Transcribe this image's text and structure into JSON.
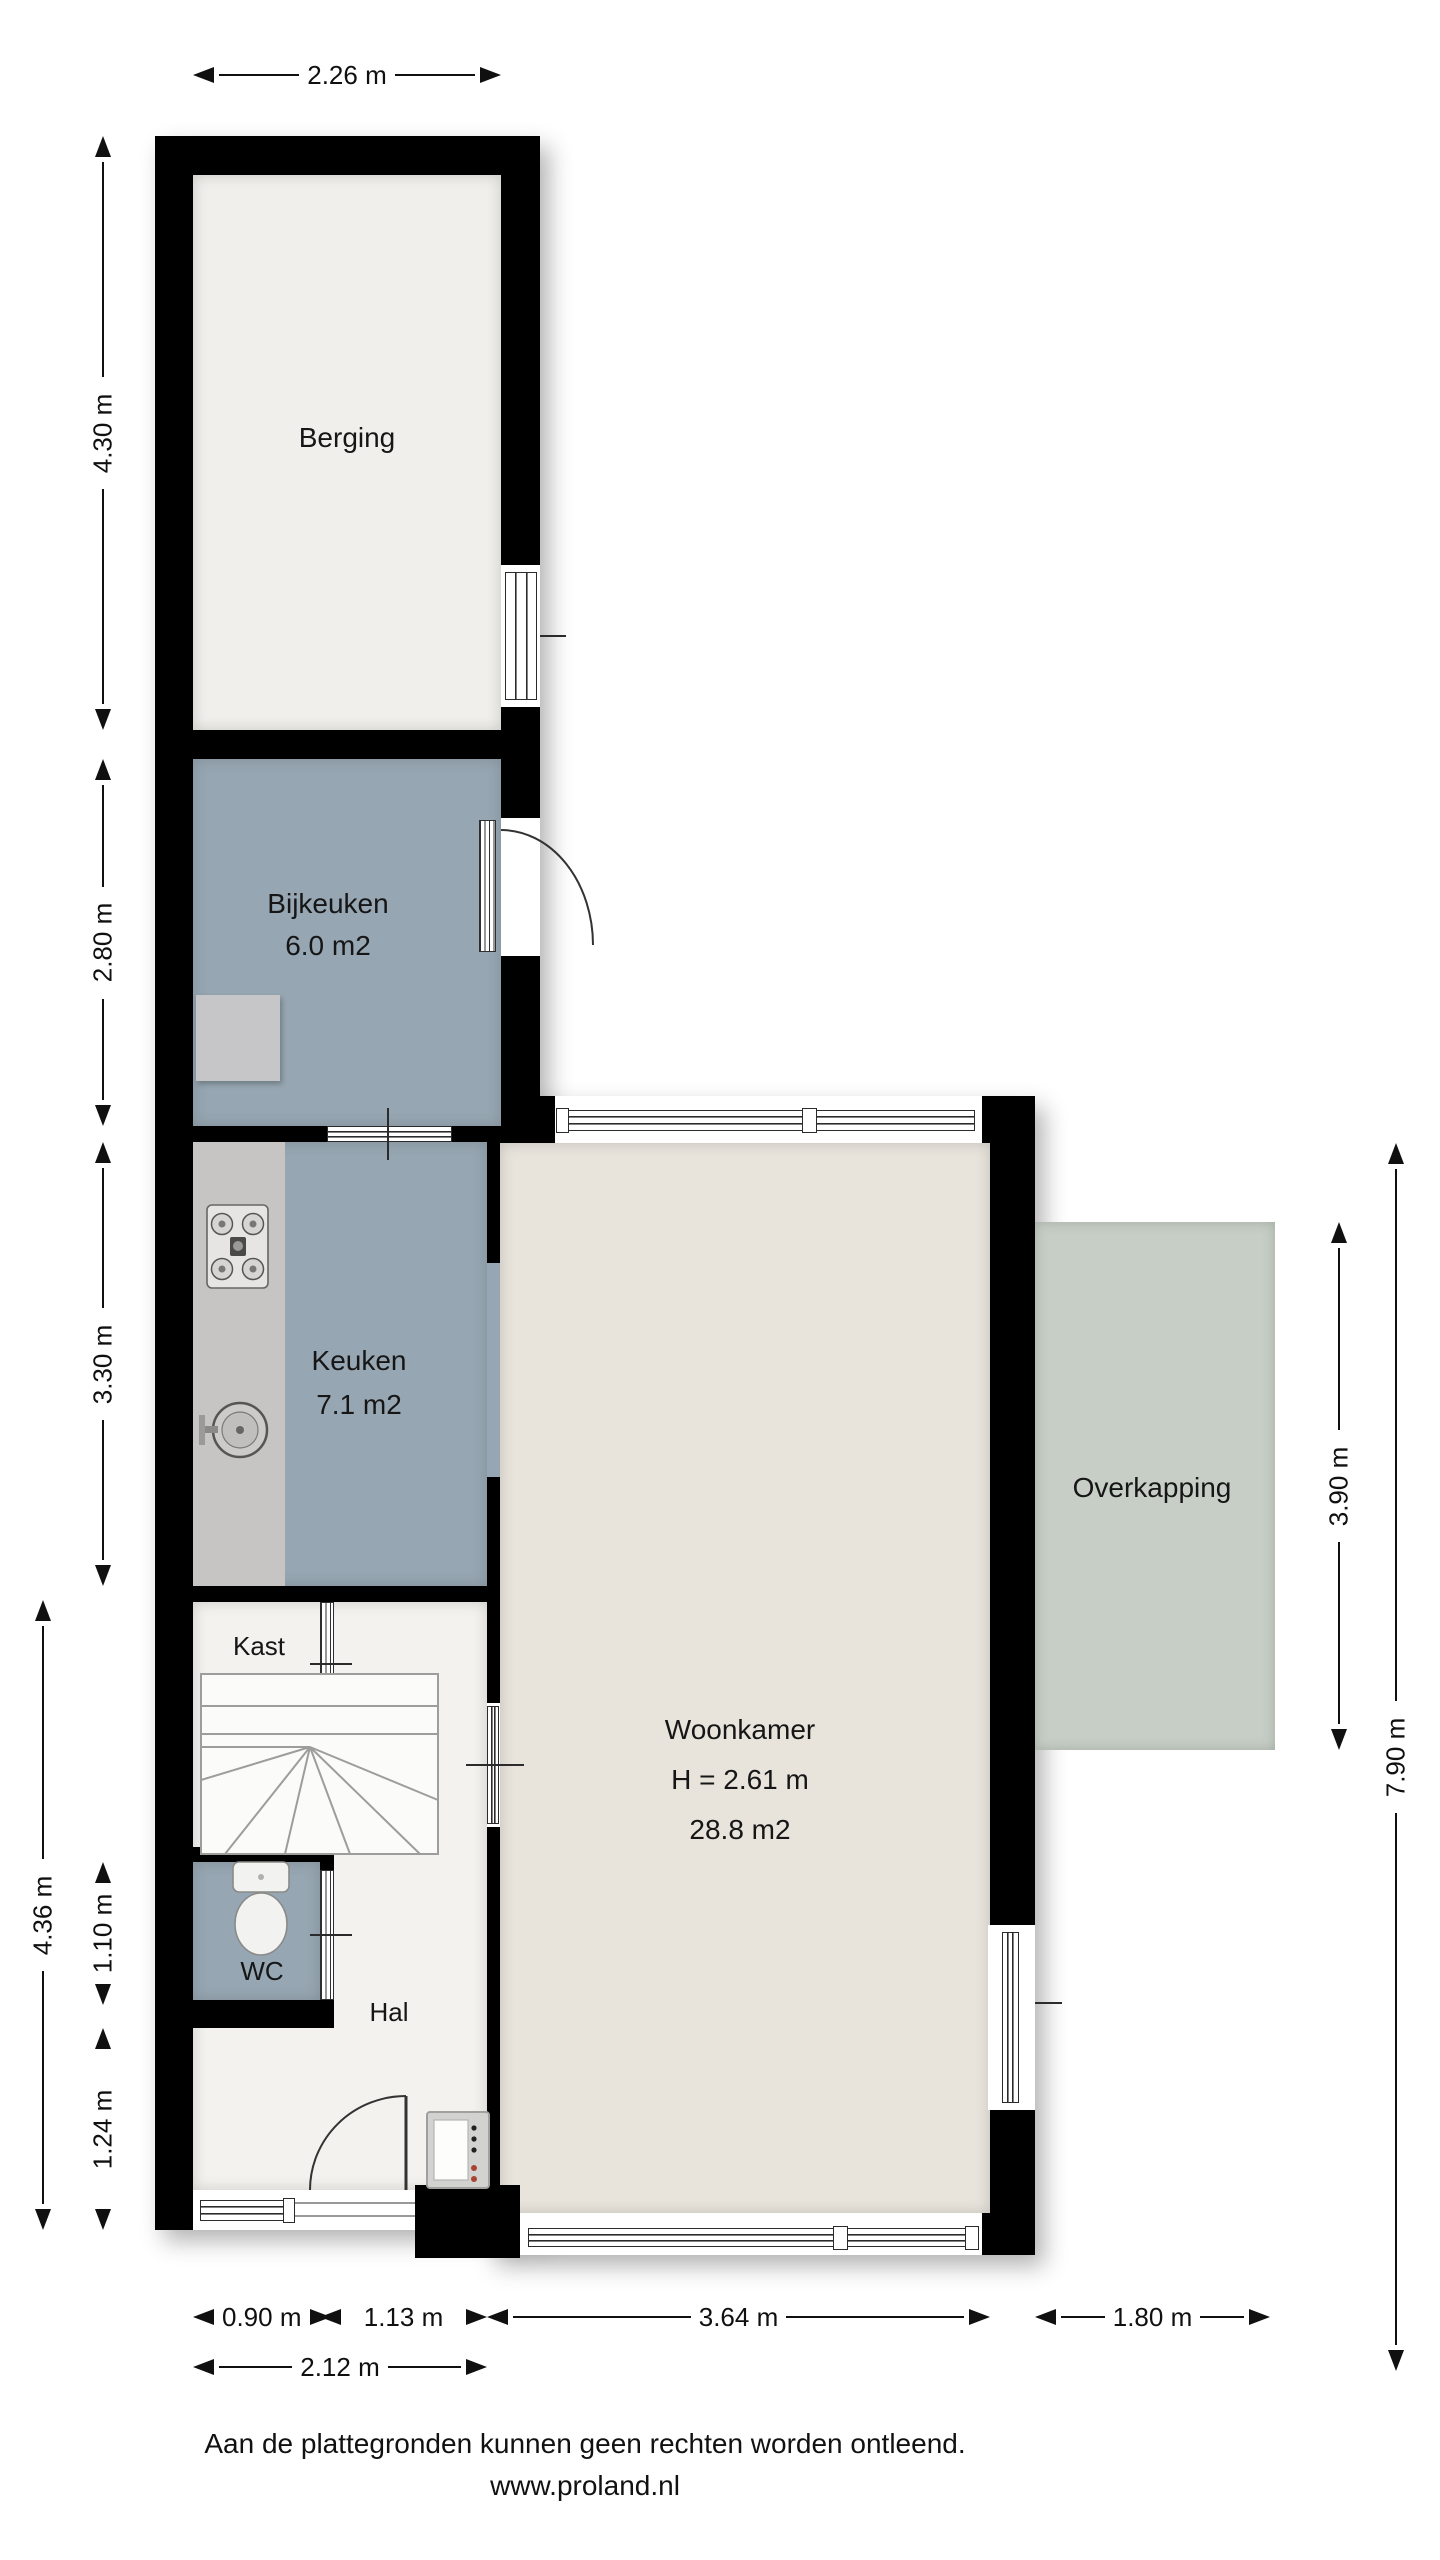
{
  "rooms": {
    "berging": {
      "label": "Berging"
    },
    "bijkeuken": {
      "label": "Bijkeuken",
      "area": "6.0 m2"
    },
    "keuken": {
      "label": "Keuken",
      "area": "7.1 m2"
    },
    "woonkamer": {
      "label": "Woonkamer",
      "ceiling_height": "H = 2.61 m",
      "area": "28.8 m2"
    },
    "overkapping": {
      "label": "Overkapping"
    },
    "kast": {
      "label": "Kast"
    },
    "wc": {
      "label": "WC"
    },
    "hal": {
      "label": "Hal"
    }
  },
  "dimensions": {
    "top": {
      "berging_width": "2.26 m"
    },
    "left_inner": {
      "berging": "4.30 m",
      "bijkeuken": "2.80 m",
      "keuken": "3.30 m",
      "wc": "1.10 m",
      "hal": "1.24 m"
    },
    "left_outer": {
      "hall_total": "4.36 m"
    },
    "right": {
      "overkapping_depth": "3.90 m",
      "side_total": "7.90 m"
    },
    "bottom_inner": {
      "window": "0.90 m",
      "entrance": "1.13 m",
      "woonkamer": "3.64 m",
      "overkapping": "1.80 m"
    },
    "bottom_outer": {
      "front_total": "2.12 m"
    }
  },
  "footer": {
    "disclaimer": "Aan de plattegronden kunnen geen rechten worden ontleend.",
    "website": "www.proland.nl"
  },
  "fixtures": {
    "stairs": "winder-staircase",
    "stove": "4-burner-hob",
    "sink": "round-kitchen-sink",
    "toilet": "toilet",
    "meter_box": "meter-cabinet"
  },
  "colors": {
    "wall": "#000000",
    "wet_rooms": "#96a6b2",
    "living_room": "#e8e4dc",
    "storage": "#f0efeb",
    "hall": "#f3f2ee",
    "canopy": "#c6cec6",
    "counter": "#c6c5c3"
  }
}
